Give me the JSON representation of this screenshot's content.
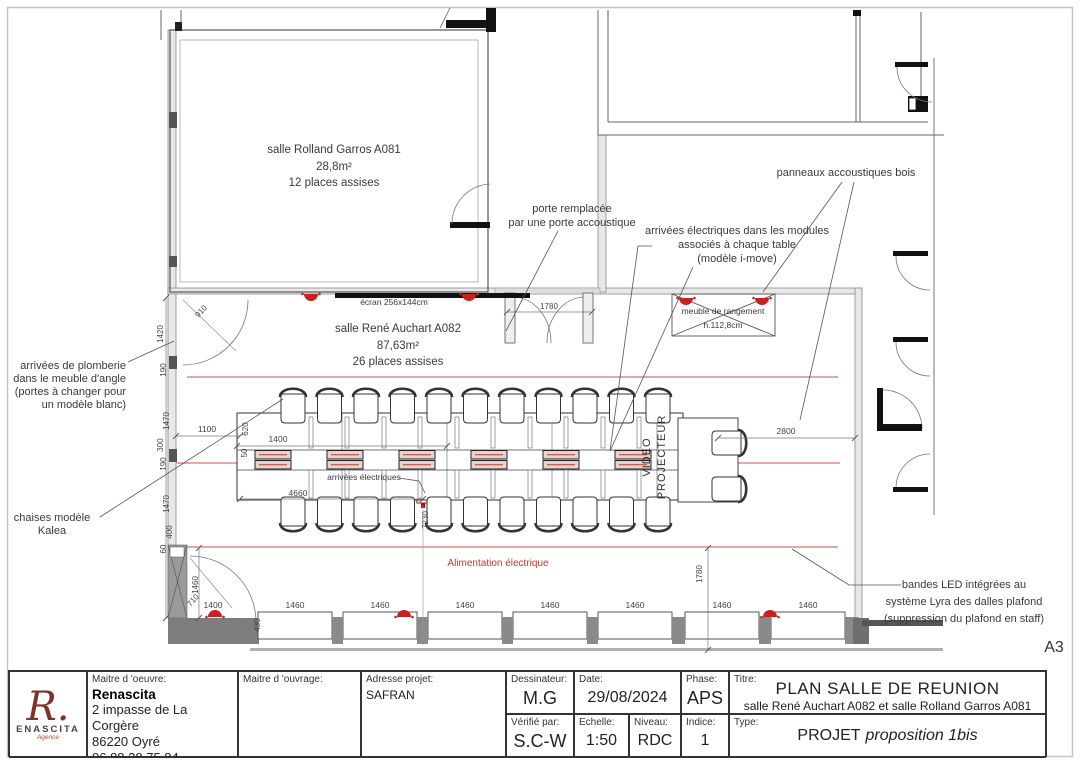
{
  "sheet": {
    "format_label": "A3"
  },
  "rooms": {
    "room1": [
      "salle Rolland Garros A081",
      "28,8m²",
      "12 places assises"
    ],
    "room2": [
      "salle René Auchart A082",
      "87,63m²",
      "26 places assises"
    ]
  },
  "annotations": {
    "plomberie": [
      "arrivées de plomberie",
      "dans le meuble d'angle",
      "(portes à changer pour",
      "un modèle blanc)"
    ],
    "chaises": [
      "chaises modèle",
      "Kalea"
    ],
    "porte": [
      "porte remplacée",
      "par une porte accoustique"
    ],
    "modules": [
      "arrivées électriques dans les modules",
      "associés à chaque table",
      "(modèle i-move)"
    ],
    "panneaux": "panneaux accoustiques bois",
    "meuble": [
      "meuble de rangement",
      "h.112,8cm"
    ],
    "led": [
      "bandes LED intégrées au",
      "système Lyra des dalles plafond",
      "(suppression du plafond en staff)"
    ],
    "ecran": "écran 256x144cm",
    "alim": "Alimentation électrique",
    "arrivees": "arrivées électriques",
    "video": [
      "VIDEO",
      "PROJECTEUR"
    ]
  },
  "dims": {
    "left": [
      "910",
      "1420",
      "190",
      "1470",
      "300",
      "190",
      "1470",
      "400",
      "60",
      "1460",
      "710"
    ],
    "bottom": [
      "1400",
      "1460",
      "1460",
      "1460",
      "1460",
      "1460",
      "1460",
      "1460"
    ],
    "inner": {
      "w1100": "1100",
      "w1400": "1400",
      "h620": "620",
      "h50": "50",
      "w4660": "4660",
      "h7230": "7230",
      "w2800": "2800",
      "door1780": "1780",
      "h430": "430",
      "v1780": "1780"
    }
  },
  "titleblock": {
    "maitre_oeuvre_label": "Maitre d 'oeuvre:",
    "maitre_oeuvre": [
      "Renascita",
      "2 impasse de La Corgère",
      "86220 Oyré",
      "06 88 28 75 84"
    ],
    "maitre_ouvrage_label": "Maitre d 'ouvrage:",
    "adresse_label": "Adresse projet:",
    "adresse": "SAFRAN",
    "dessinateur_label": "Dessinateur:",
    "dessinateur": "M.G",
    "date_label": "Date:",
    "date": "29/08/2024",
    "phase_label": "Phase:",
    "phase": "APS",
    "verifie_label": "Vérifié par:",
    "verifie": "S.C-W",
    "echelle_label": "Echelle:",
    "echelle": "1:50",
    "niveau_label": "Niveau:",
    "niveau": "RDC",
    "indice_label": "Indice:",
    "indice": "1",
    "titre_label": "Titre:",
    "titre": "PLAN SALLE DE REUNION",
    "sous_titre": "salle René Auchart A082 et salle Rolland Garros A081",
    "type_label": "Type:",
    "type_main": "PROJET",
    "type_italic": "proposition 1bis",
    "logo_letter": "R.",
    "logo_name": "ENASCITA",
    "logo_sub": "Agence"
  }
}
